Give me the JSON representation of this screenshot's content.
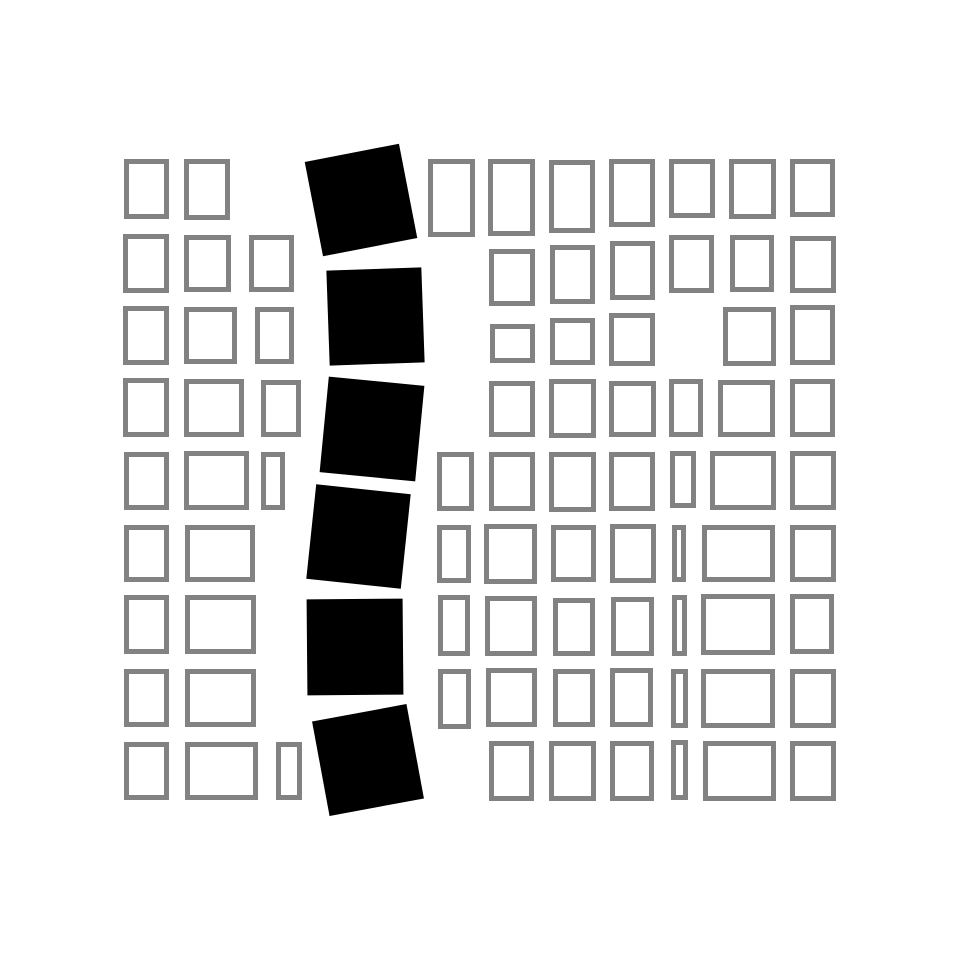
{
  "artwork": {
    "title": "abstract-grid-composition",
    "canvas": {
      "width": 960,
      "height": 960,
      "background": "#ffffff"
    },
    "style": {
      "stroke_color": "#828282",
      "stroke_width": 5,
      "square_fill": "#000000"
    },
    "outlined_rects": [
      {
        "x": 124,
        "y": 159,
        "w": 45,
        "h": 60
      },
      {
        "x": 184,
        "y": 159,
        "w": 46,
        "h": 61
      },
      {
        "x": 428,
        "y": 159,
        "w": 47,
        "h": 78
      },
      {
        "x": 488,
        "y": 159,
        "w": 47,
        "h": 77
      },
      {
        "x": 549,
        "y": 160,
        "w": 46,
        "h": 73
      },
      {
        "x": 609,
        "y": 159,
        "w": 46,
        "h": 68
      },
      {
        "x": 669,
        "y": 159,
        "w": 46,
        "h": 59
      },
      {
        "x": 729,
        "y": 159,
        "w": 47,
        "h": 60
      },
      {
        "x": 790,
        "y": 159,
        "w": 45,
        "h": 58
      },
      {
        "x": 123,
        "y": 234,
        "w": 46,
        "h": 59
      },
      {
        "x": 184,
        "y": 235,
        "w": 47,
        "h": 57
      },
      {
        "x": 249,
        "y": 235,
        "w": 45,
        "h": 57
      },
      {
        "x": 489,
        "y": 249,
        "w": 46,
        "h": 57
      },
      {
        "x": 550,
        "y": 245,
        "w": 45,
        "h": 59
      },
      {
        "x": 610,
        "y": 241,
        "w": 45,
        "h": 59
      },
      {
        "x": 669,
        "y": 235,
        "w": 45,
        "h": 58
      },
      {
        "x": 730,
        "y": 235,
        "w": 44,
        "h": 57
      },
      {
        "x": 790,
        "y": 236,
        "w": 46,
        "h": 57
      },
      {
        "x": 123,
        "y": 306,
        "w": 46,
        "h": 59
      },
      {
        "x": 184,
        "y": 307,
        "w": 53,
        "h": 57
      },
      {
        "x": 255,
        "y": 307,
        "w": 39,
        "h": 57
      },
      {
        "x": 490,
        "y": 324,
        "w": 45,
        "h": 39
      },
      {
        "x": 550,
        "y": 318,
        "w": 45,
        "h": 47
      },
      {
        "x": 609,
        "y": 313,
        "w": 46,
        "h": 53
      },
      {
        "x": 723,
        "y": 307,
        "w": 53,
        "h": 59
      },
      {
        "x": 790,
        "y": 305,
        "w": 45,
        "h": 60
      },
      {
        "x": 123,
        "y": 378,
        "w": 46,
        "h": 59
      },
      {
        "x": 184,
        "y": 379,
        "w": 60,
        "h": 58
      },
      {
        "x": 261,
        "y": 380,
        "w": 40,
        "h": 57
      },
      {
        "x": 489,
        "y": 381,
        "w": 46,
        "h": 56
      },
      {
        "x": 549,
        "y": 379,
        "w": 47,
        "h": 59
      },
      {
        "x": 609,
        "y": 381,
        "w": 47,
        "h": 56
      },
      {
        "x": 669,
        "y": 379,
        "w": 34,
        "h": 58
      },
      {
        "x": 718,
        "y": 380,
        "w": 57,
        "h": 57
      },
      {
        "x": 790,
        "y": 379,
        "w": 45,
        "h": 58
      },
      {
        "x": 124,
        "y": 452,
        "w": 45,
        "h": 58
      },
      {
        "x": 184,
        "y": 451,
        "w": 65,
        "h": 59
      },
      {
        "x": 261,
        "y": 452,
        "w": 24,
        "h": 58
      },
      {
        "x": 437,
        "y": 452,
        "w": 37,
        "h": 59
      },
      {
        "x": 489,
        "y": 452,
        "w": 46,
        "h": 59
      },
      {
        "x": 549,
        "y": 452,
        "w": 47,
        "h": 60
      },
      {
        "x": 609,
        "y": 452,
        "w": 46,
        "h": 59
      },
      {
        "x": 670,
        "y": 451,
        "w": 26,
        "h": 57
      },
      {
        "x": 710,
        "y": 451,
        "w": 66,
        "h": 59
      },
      {
        "x": 790,
        "y": 451,
        "w": 46,
        "h": 59
      },
      {
        "x": 124,
        "y": 525,
        "w": 45,
        "h": 57
      },
      {
        "x": 185,
        "y": 525,
        "w": 70,
        "h": 57
      },
      {
        "x": 437,
        "y": 525,
        "w": 34,
        "h": 58
      },
      {
        "x": 484,
        "y": 524,
        "w": 53,
        "h": 60
      },
      {
        "x": 551,
        "y": 525,
        "w": 45,
        "h": 57
      },
      {
        "x": 610,
        "y": 524,
        "w": 46,
        "h": 59
      },
      {
        "x": 672,
        "y": 525,
        "w": 14,
        "h": 57
      },
      {
        "x": 702,
        "y": 525,
        "w": 73,
        "h": 57
      },
      {
        "x": 790,
        "y": 525,
        "w": 46,
        "h": 57
      },
      {
        "x": 124,
        "y": 595,
        "w": 45,
        "h": 59
      },
      {
        "x": 185,
        "y": 595,
        "w": 71,
        "h": 59
      },
      {
        "x": 438,
        "y": 595,
        "w": 32,
        "h": 61
      },
      {
        "x": 485,
        "y": 596,
        "w": 52,
        "h": 60
      },
      {
        "x": 553,
        "y": 598,
        "w": 42,
        "h": 58
      },
      {
        "x": 611,
        "y": 597,
        "w": 43,
        "h": 59
      },
      {
        "x": 672,
        "y": 595,
        "w": 15,
        "h": 61
      },
      {
        "x": 701,
        "y": 594,
        "w": 74,
        "h": 61
      },
      {
        "x": 790,
        "y": 594,
        "w": 44,
        "h": 60
      },
      {
        "x": 124,
        "y": 669,
        "w": 45,
        "h": 58
      },
      {
        "x": 185,
        "y": 669,
        "w": 71,
        "h": 58
      },
      {
        "x": 438,
        "y": 669,
        "w": 33,
        "h": 60
      },
      {
        "x": 486,
        "y": 668,
        "w": 51,
        "h": 59
      },
      {
        "x": 553,
        "y": 669,
        "w": 42,
        "h": 58
      },
      {
        "x": 610,
        "y": 668,
        "w": 43,
        "h": 59
      },
      {
        "x": 671,
        "y": 669,
        "w": 17,
        "h": 59
      },
      {
        "x": 701,
        "y": 669,
        "w": 74,
        "h": 59
      },
      {
        "x": 790,
        "y": 669,
        "w": 46,
        "h": 59
      },
      {
        "x": 124,
        "y": 742,
        "w": 45,
        "h": 58
      },
      {
        "x": 185,
        "y": 742,
        "w": 73,
        "h": 58
      },
      {
        "x": 276,
        "y": 742,
        "w": 26,
        "h": 58
      },
      {
        "x": 489,
        "y": 741,
        "w": 45,
        "h": 60
      },
      {
        "x": 549,
        "y": 741,
        "w": 47,
        "h": 60
      },
      {
        "x": 610,
        "y": 741,
        "w": 44,
        "h": 60
      },
      {
        "x": 671,
        "y": 740,
        "w": 17,
        "h": 60
      },
      {
        "x": 703,
        "y": 741,
        "w": 73,
        "h": 60
      },
      {
        "x": 790,
        "y": 741,
        "w": 46,
        "h": 60
      }
    ],
    "black_squares": [
      {
        "cx": 361,
        "cy": 200,
        "size": 96,
        "rotation": -11
      },
      {
        "cx": 375,
        "cy": 316,
        "size": 95,
        "rotation": -2
      },
      {
        "cx": 372,
        "cy": 429,
        "size": 96,
        "rotation": 5.5
      },
      {
        "cx": 358,
        "cy": 536,
        "size": 95,
        "rotation": 6
      },
      {
        "cx": 355,
        "cy": 647,
        "size": 96,
        "rotation": -0.5
      },
      {
        "cx": 368,
        "cy": 760,
        "size": 96,
        "rotation": -10.5
      }
    ]
  }
}
